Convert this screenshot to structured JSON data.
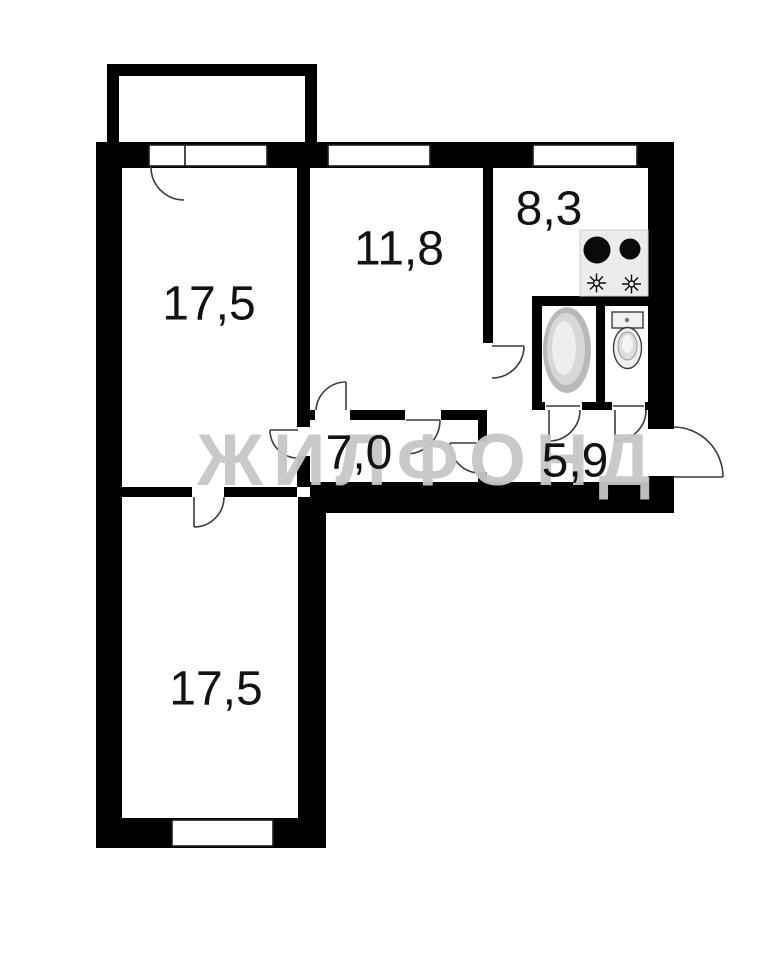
{
  "watermark": {
    "text": "ЖИЛФОНД",
    "color": "#c7c7c7"
  },
  "rooms": [
    {
      "name": "room-top-left",
      "area": "17,5"
    },
    {
      "name": "room-middle",
      "area": "11,8"
    },
    {
      "name": "kitchen",
      "area": "8,3"
    },
    {
      "name": "hallway",
      "area": "7,0"
    },
    {
      "name": "hall-entry",
      "area": "5,9"
    },
    {
      "name": "room-bottom-left",
      "area": "17,5"
    }
  ],
  "colors": {
    "wall": "#000000",
    "background": "#ffffff",
    "door_line": "#3c3c3c",
    "stove_fill": "#ececec",
    "burner": "#0a0a0a",
    "fixture_fill": "#f1f1f1"
  },
  "icons": [
    "balcony",
    "stove-icon",
    "bathtub-icon",
    "toilet-icon",
    "entrance-door-icon",
    "window",
    "door-arc"
  ]
}
